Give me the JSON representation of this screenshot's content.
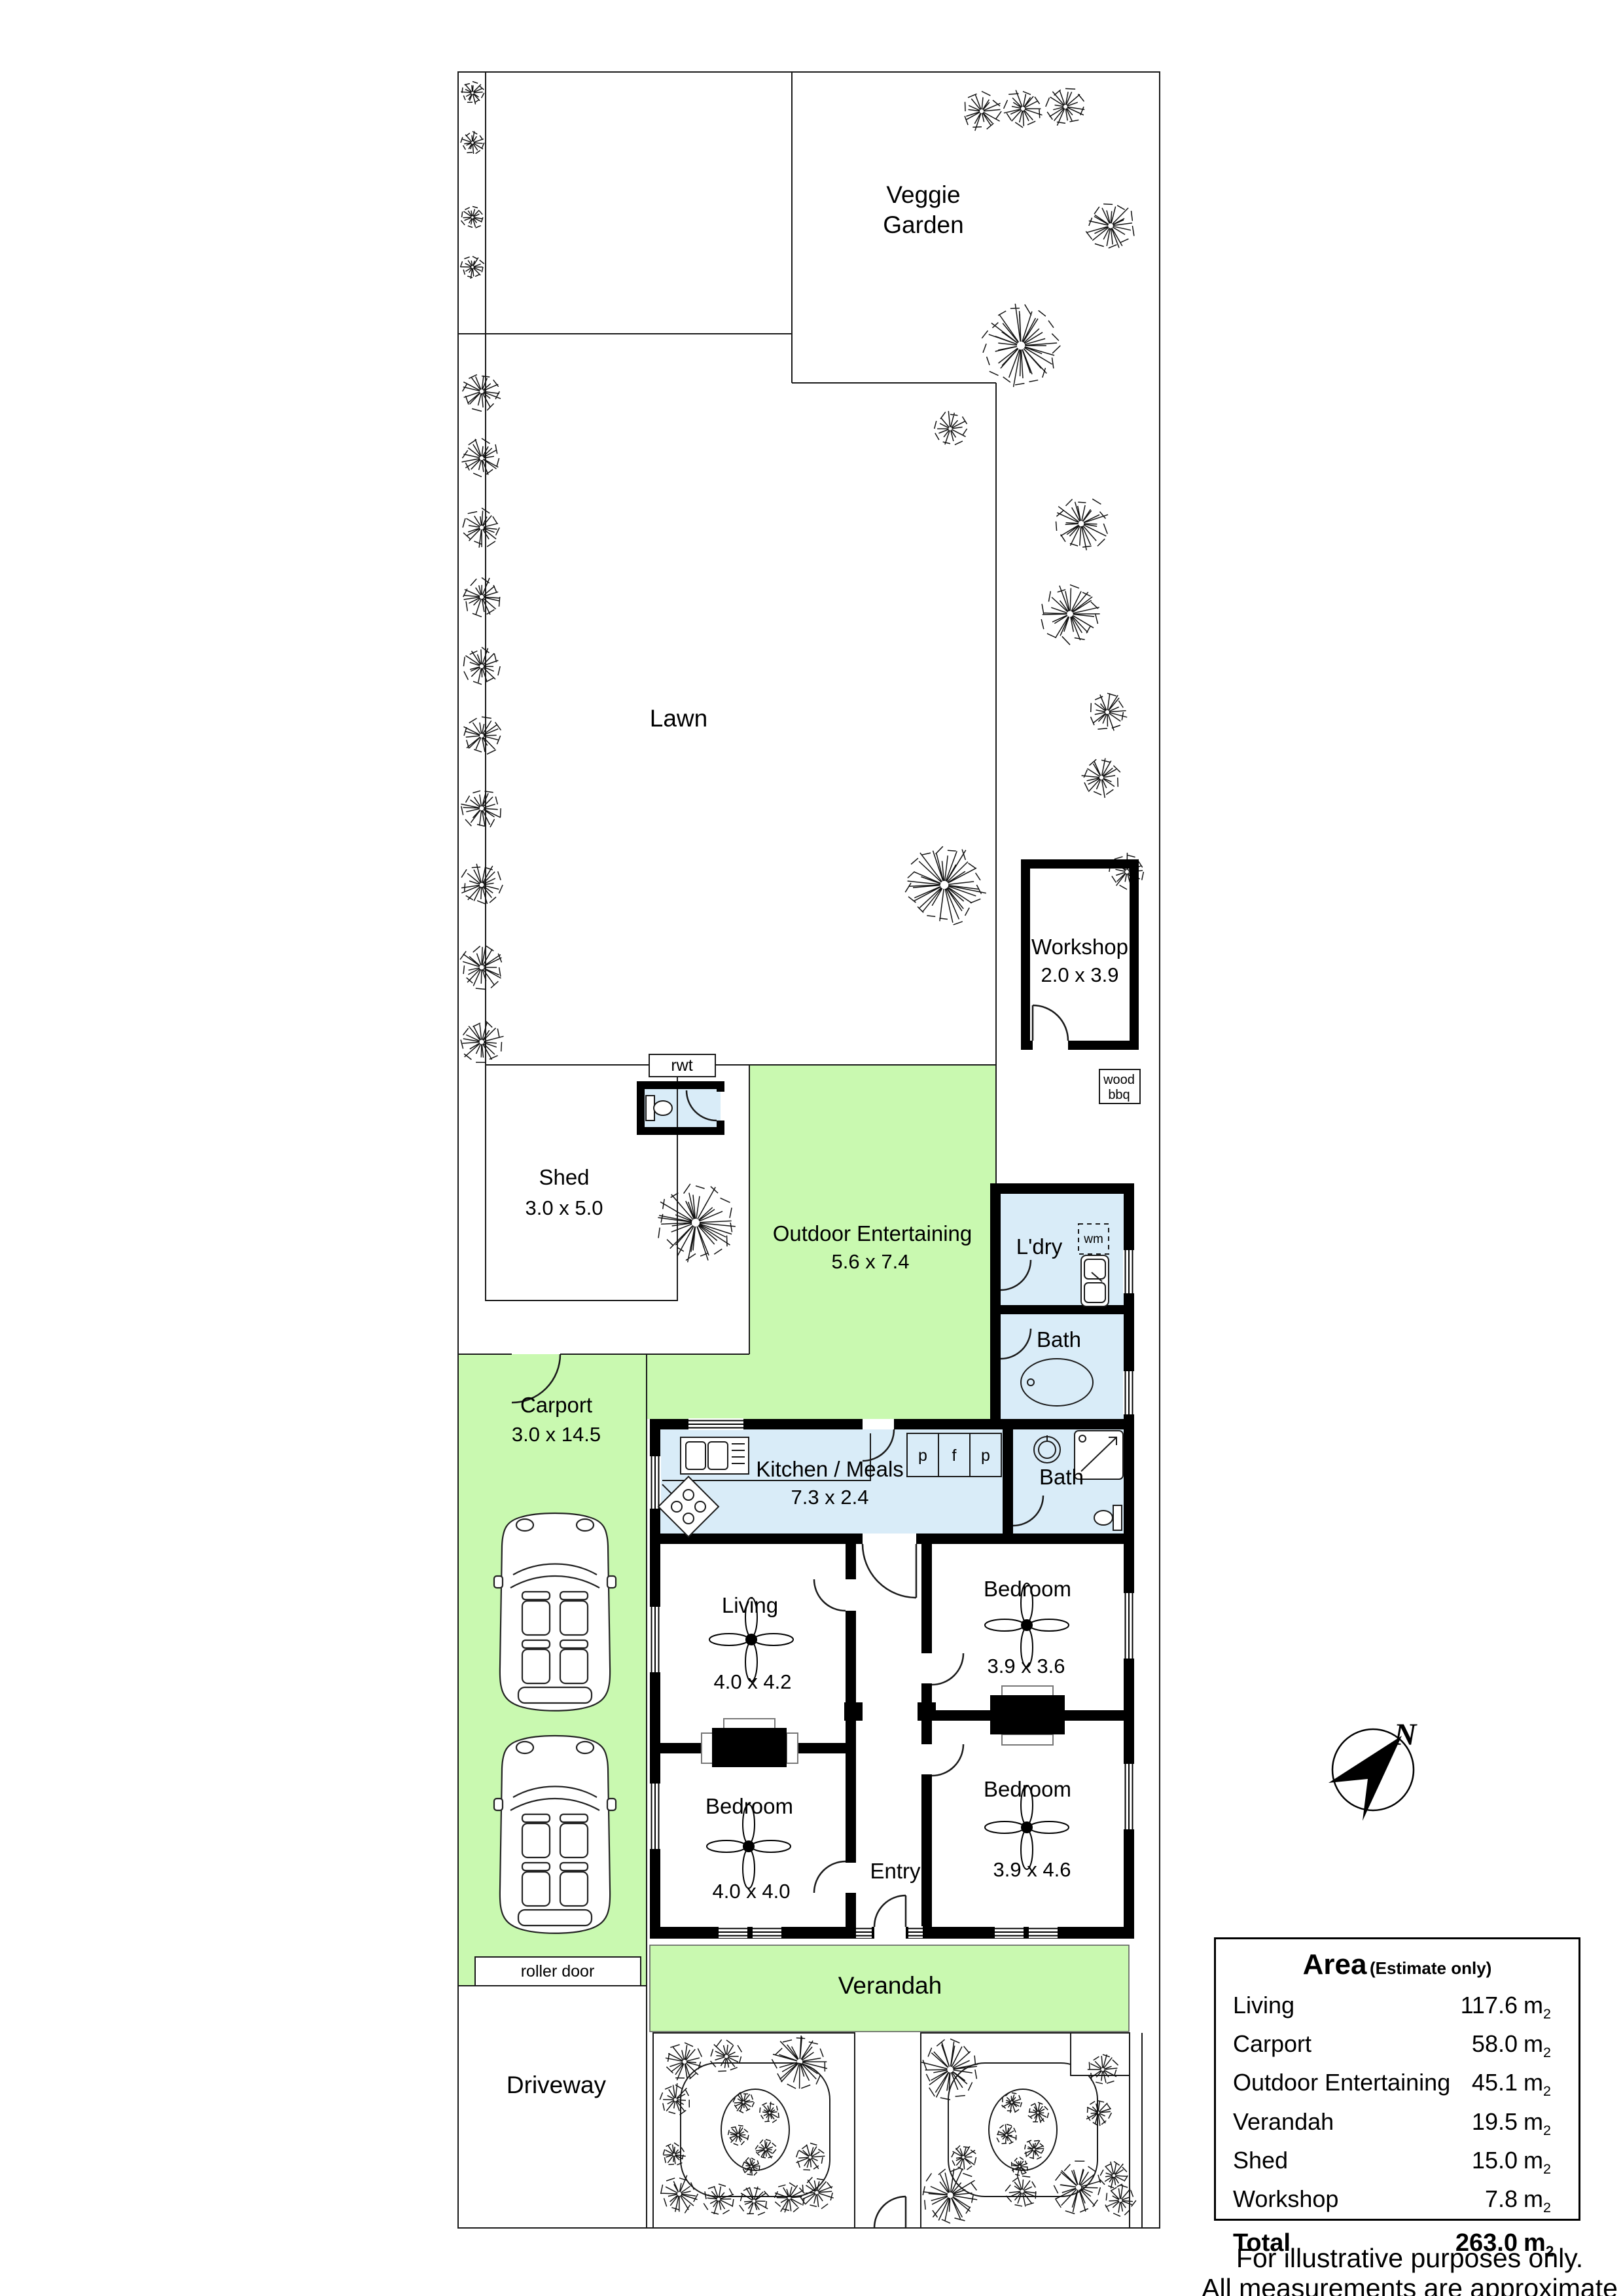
{
  "colors": {
    "outdoor_green": "#c9f9b0",
    "wet_blue": "#d9ecf8",
    "wall_black": "#000000",
    "line": "#1a1a1a"
  },
  "site": {
    "veggie_garden": {
      "line1": "Veggie",
      "line2": "Garden"
    },
    "lawn": {
      "label": "Lawn"
    },
    "workshop": {
      "label": "Workshop",
      "dims": "2.0 x 3.9"
    },
    "shed": {
      "label": "Shed",
      "dims": "3.0 x 5.0"
    },
    "outdoor_entertaining": {
      "label": "Outdoor Entertaining",
      "dims": "5.6 x 7.4"
    },
    "carport": {
      "label": "Carport",
      "dims": "3.0 x 14.5"
    },
    "verandah": {
      "label": "Verandah"
    },
    "driveway": {
      "label": "Driveway"
    },
    "roller_door": {
      "label": "roller door"
    },
    "rwt": {
      "label": "rwt"
    },
    "wood_bbq": {
      "line1": "wood",
      "line2": "bbq"
    },
    "compass": {
      "north": "N"
    }
  },
  "house": {
    "kitchen": {
      "label": "Kitchen / Meals",
      "dims": "7.3 x 2.4"
    },
    "laundry": {
      "label": "L'dry",
      "wm": "wm"
    },
    "bath_rear": {
      "label": "Bath"
    },
    "bath_front": {
      "label": "Bath"
    },
    "living": {
      "label": "Living",
      "dims": "4.0 x 4.2"
    },
    "bedroom_rear": {
      "label": "Bedroom",
      "dims": "3.9 x 3.6"
    },
    "bedroom_left": {
      "label": "Bedroom",
      "dims": "4.0 x 4.0"
    },
    "bedroom_front": {
      "label": "Bedroom",
      "dims": "3.9 x 4.6"
    },
    "entry": {
      "label": "Entry"
    },
    "cupboards": {
      "p1": "p",
      "f": "f",
      "p2": "p"
    }
  },
  "area_table": {
    "title": "Area",
    "subtitle": "(Estimate only)",
    "unit": "m",
    "unit_sub": "2",
    "rows": [
      {
        "label": "Living",
        "value": "117.6"
      },
      {
        "label": "Carport",
        "value": "58.0"
      },
      {
        "label": "Outdoor Entertaining",
        "value": "45.1"
      },
      {
        "label": "Verandah",
        "value": "19.5"
      },
      {
        "label": "Shed",
        "value": "15.0"
      },
      {
        "label": "Workshop",
        "value": "7.8"
      }
    ],
    "total": {
      "label": "Total",
      "value": "263.0"
    }
  },
  "footer": {
    "line1": "For illustrative purposes only.",
    "line2": "All measurements are approximate"
  },
  "trees": [
    [
      722,
      142,
      18
    ],
    [
      722,
      218,
      18
    ],
    [
      722,
      332,
      18
    ],
    [
      722,
      408,
      18
    ],
    [
      736,
      598,
      30
    ],
    [
      736,
      700,
      30
    ],
    [
      736,
      806,
      30
    ],
    [
      736,
      912,
      30
    ],
    [
      736,
      1018,
      30
    ],
    [
      736,
      1124,
      30
    ],
    [
      736,
      1235,
      32
    ],
    [
      736,
      1352,
      32
    ],
    [
      736,
      1478,
      34
    ],
    [
      736,
      1592,
      34
    ],
    [
      1500,
      170,
      30
    ],
    [
      1563,
      166,
      30
    ],
    [
      1628,
      163,
      30
    ],
    [
      1697,
      345,
      38
    ],
    [
      1560,
      528,
      62
    ],
    [
      1452,
      655,
      26
    ],
    [
      1652,
      800,
      42
    ],
    [
      1635,
      938,
      46
    ],
    [
      1692,
      1088,
      30
    ],
    [
      1683,
      1188,
      30
    ],
    [
      1722,
      1332,
      28
    ],
    [
      1443,
      1352,
      62
    ],
    [
      1063,
      1868,
      60
    ],
    [
      1046,
      3150,
      30
    ],
    [
      1110,
      3142,
      26
    ],
    [
      1222,
      3150,
      42
    ],
    [
      1032,
      3208,
      24
    ],
    [
      1030,
      3292,
      18
    ],
    [
      1238,
      3296,
      22
    ],
    [
      1038,
      3352,
      30
    ],
    [
      1098,
      3360,
      24
    ],
    [
      1152,
      3363,
      24
    ],
    [
      1206,
      3358,
      24
    ],
    [
      1248,
      3350,
      26
    ],
    [
      1136,
      3212,
      16
    ],
    [
      1176,
      3228,
      16
    ],
    [
      1128,
      3262,
      16
    ],
    [
      1170,
      3284,
      16
    ],
    [
      1148,
      3310,
      14
    ],
    [
      1452,
      3162,
      46
    ],
    [
      1685,
      3162,
      24
    ],
    [
      1678,
      3228,
      20
    ],
    [
      1472,
      3296,
      20
    ],
    [
      1452,
      3354,
      44
    ],
    [
      1562,
      3348,
      26
    ],
    [
      1648,
      3342,
      40
    ],
    [
      1702,
      3324,
      22
    ],
    [
      1712,
      3362,
      24
    ],
    [
      1546,
      3212,
      16
    ],
    [
      1586,
      3228,
      16
    ],
    [
      1538,
      3262,
      16
    ],
    [
      1580,
      3284,
      16
    ],
    [
      1558,
      3310,
      14
    ]
  ]
}
